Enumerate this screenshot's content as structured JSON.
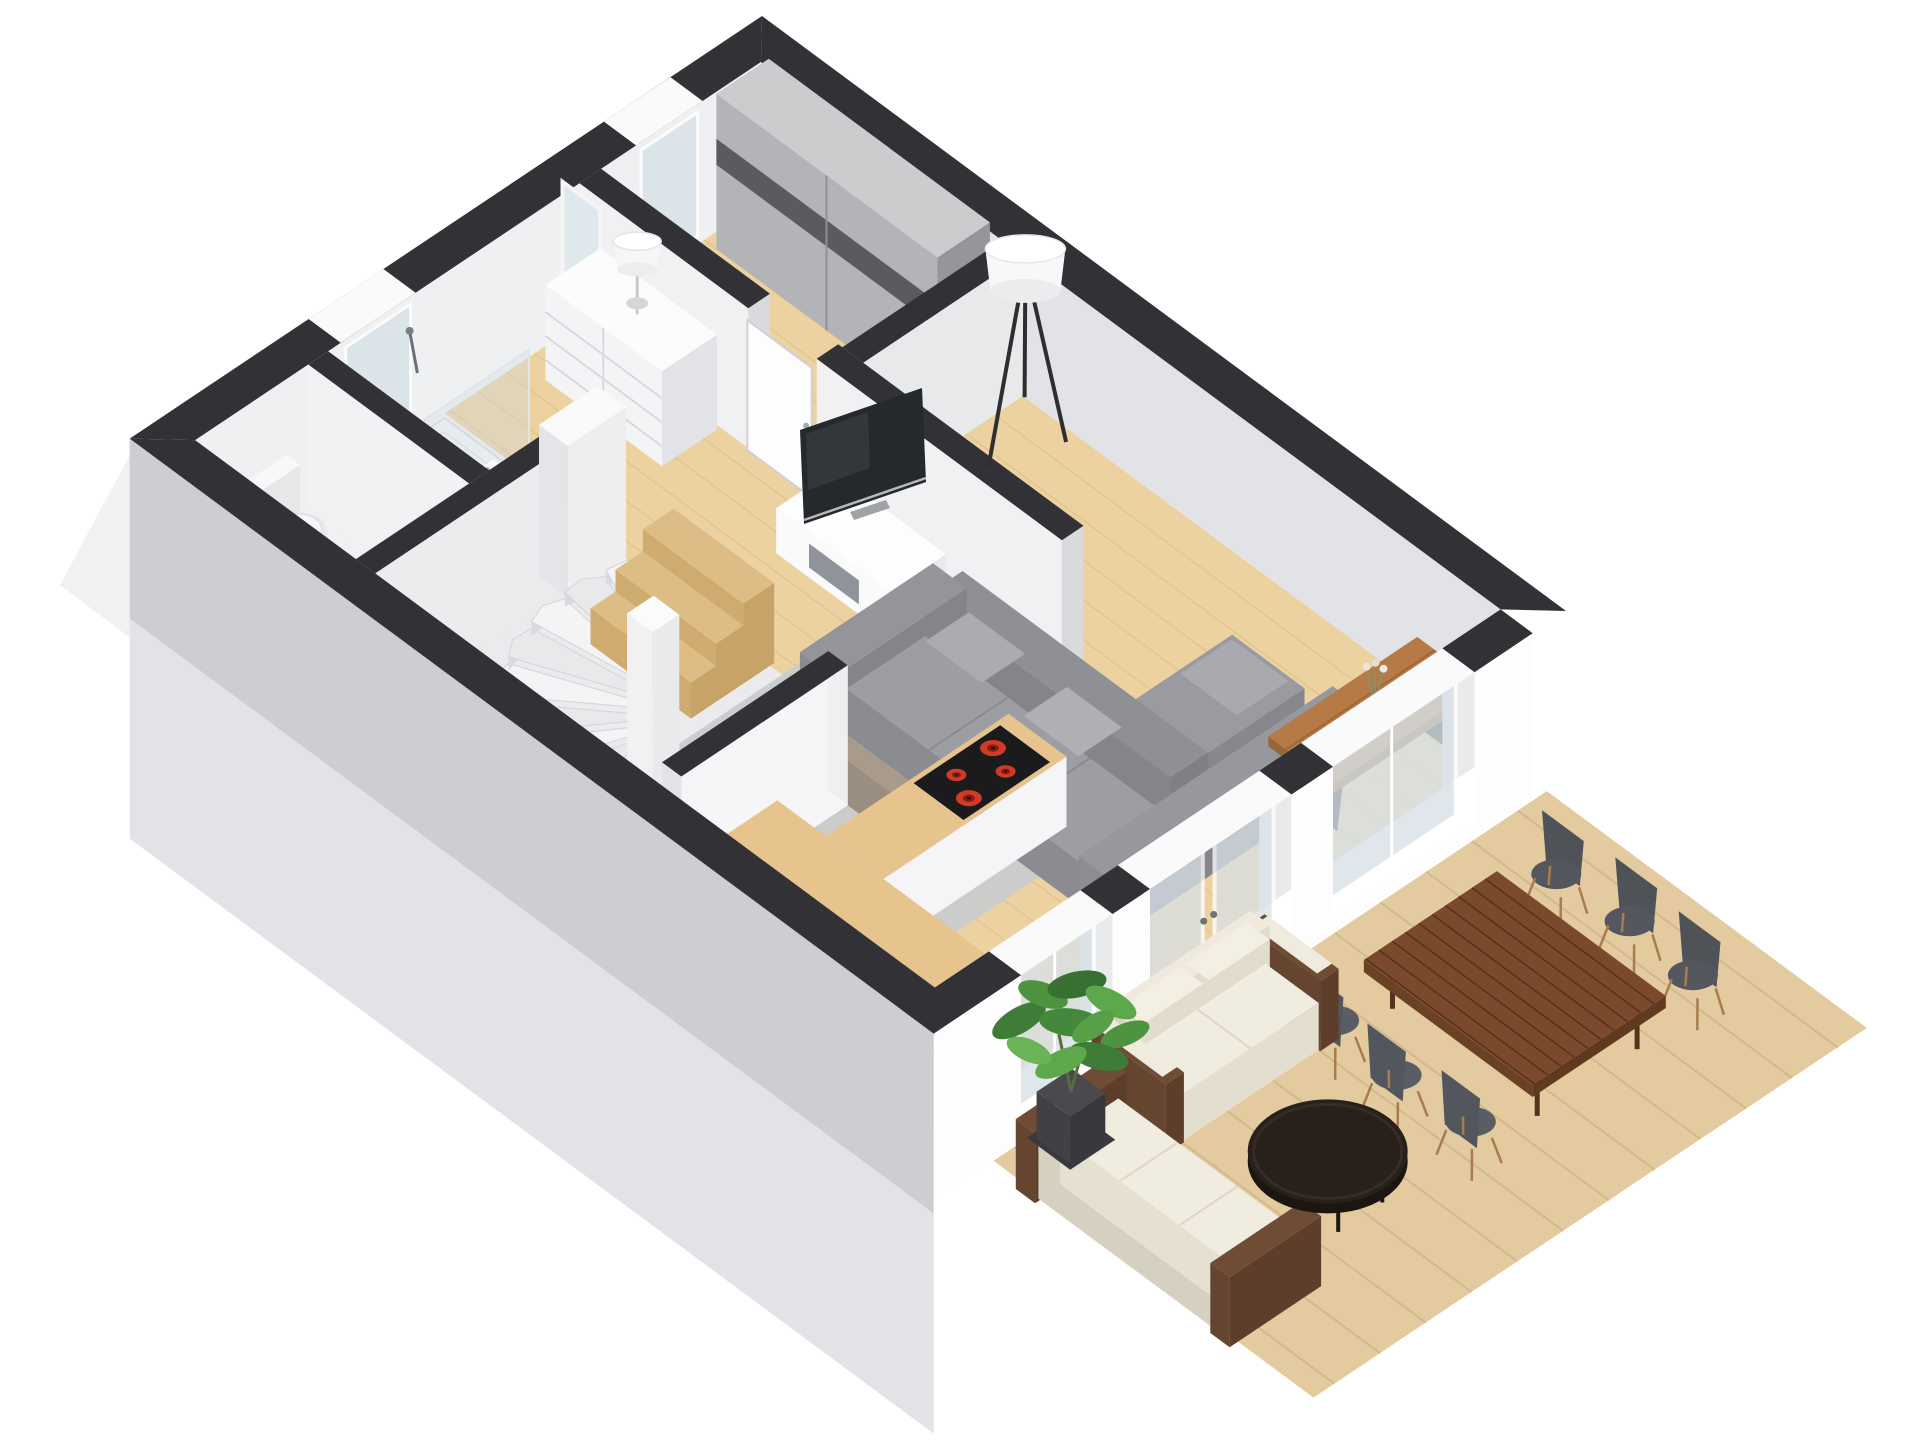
{
  "scene": {
    "type": "3d-floor-plan",
    "style": "isometric cutaway dollhouse render, ground floor",
    "has_text": false
  },
  "palette": {
    "bg": "#ffffff",
    "cap": "#323236",
    "capLight": "#3c3c40",
    "extWallTop": "#cdced1",
    "extWallBottom": "#e2e3e6",
    "innerWallBright": "#f2f2f4",
    "innerWallLight": "#eef0f2",
    "innerWallMid": "#e2e3e6",
    "floorWood": "#ecd1a1",
    "floorLine": "#d9ba85",
    "bathFloor": "#f0f1f2",
    "stairFloor": "#ebebee",
    "deckWood": "#e3cb9f",
    "deckLine": "#cdb088",
    "glass": "#d8e2e8",
    "white": "#fdfdfd",
    "sofaGray": "#94949b",
    "sofaLight": "#9d9da4",
    "rug": "#cacbce",
    "coffeeTable": "#a89b8b",
    "diningWood": "#b57a45",
    "outdoorTable": "#7b4a2c",
    "chairShell": "#54585e",
    "chairLegWood": "#a87c4e",
    "cushionCream": "#f0ebdf",
    "outdoorFrame": "#6f4c34",
    "roundTable": "#282019",
    "plantGreen": "#4e9440",
    "cooktop": "#1b1b1e",
    "burnerRed": "#d03a27",
    "wardrobeFront": "#b2b4b7",
    "wardrobeBand": "#595b5f",
    "stepWood": "#ddbc85"
  },
  "rooms": [
    {
      "name": "living-room",
      "furniture": [
        "corner-sofa-gray",
        "chaise-pillows",
        "coffee-table",
        "area-rug",
        "tv",
        "tv-stand",
        "tripod-floor-lamp",
        "dining-table-with-vase"
      ]
    },
    {
      "name": "kitchen",
      "furniture": [
        "l-shaped-counter",
        "induction-cooktop-4-red-burners"
      ]
    },
    {
      "name": "dressing-room",
      "furniture": [
        "sliding-door-wardrobe",
        "white-dresser",
        "table-lamp",
        "leaning-mirror"
      ]
    },
    {
      "name": "hallway",
      "furniture": [
        "interior-door",
        "spiral-winder-staircase",
        "wood-entry-steps"
      ]
    },
    {
      "name": "bathroom",
      "furniture": [
        "walk-in-shower",
        "glass-screen",
        "wall-hung-sink",
        "window"
      ]
    },
    {
      "name": "wc",
      "furniture": [
        "toilet"
      ]
    }
  ],
  "outdoor": {
    "name": "terrace-deck",
    "furniture": [
      "outdoor-dining-table-slatted",
      "six-gray-shell-chairs",
      "two-seat-outdoor-sofa",
      "three-seat-outdoor-sofa",
      "round-dark-coffee-table",
      "potted-plant"
    ]
  },
  "architecture": {
    "wall_cut": "low cutaway walls with dark charcoal caps",
    "facade_openings": [
      "window-by-dining",
      "french-doors",
      "window-by-kitchen",
      "bathroom-window",
      "dressing-window"
    ]
  }
}
